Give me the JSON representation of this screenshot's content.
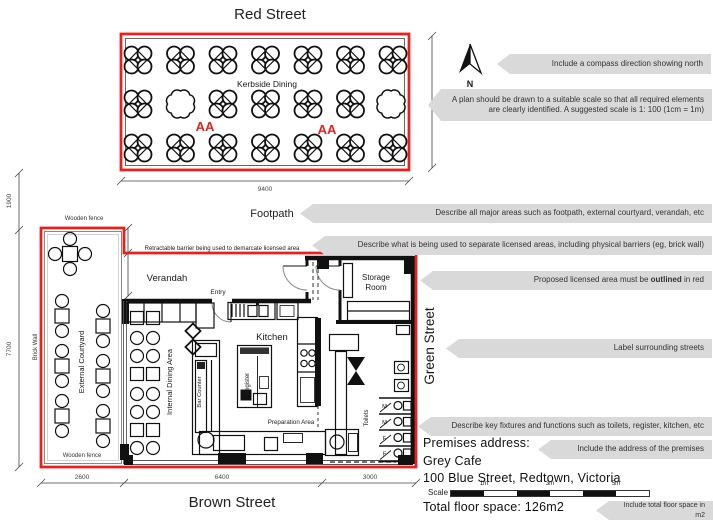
{
  "streets": {
    "top": "Red Street",
    "bottom": "Brown Street",
    "right": "Green Street",
    "footpath": "Footpath"
  },
  "kerbside": {
    "label": "Kerbside Dining",
    "area_marker_1": "AA",
    "area_marker_2": "AA"
  },
  "compass": {
    "north": "N"
  },
  "plan": {
    "verandah": "Verandah",
    "entry": "Entry",
    "kitchen": "Kitchen",
    "register": "Register",
    "storage_line1": "Storage",
    "storage_line2": "Room",
    "bar_counter": "Bar Counter",
    "internal_dining": "Internal Dining Area",
    "external_courtyard": "External Courtyard",
    "preparation_area": "Preparation Area",
    "toilets": "Toilets",
    "toilet_stalls": [
      "M",
      "M",
      "F",
      "F"
    ],
    "brick_wall": "Brick Wall",
    "wooden_fence_top": "Wooden fence",
    "wooden_fence_bottom": "Wooden fence",
    "retractable_barrier": "Retractable barrier being used to demarcate licensed area"
  },
  "dimensions": {
    "kerbside_width": "9400",
    "kerbside_depth": "4400",
    "footpath_width": "1900",
    "courtyard_depth": "7700",
    "courtyard_width": "2600",
    "building_width": "6400",
    "east_width": "3000",
    "barrier_step": "800",
    "verandah_edge": "1400"
  },
  "callouts": {
    "compass": "Include a compass direction showing north",
    "scale_note": "A plan should be drawn to a suitable scale so that all required elements are clearly identified. A suggested scale is 1: 100 (1cm = 1m)",
    "major_areas": "Describe all major areas such as footpath, external courtyard, verandah, etc",
    "separation": "Describe what is being used to separate licensed areas, including physical barriers (eg, brick wall)",
    "outline_prefix": "Proposed licensed area must be ",
    "outline_bold": "outlined",
    "outline_suffix": " in red",
    "streets_note": "Label surrounding streets",
    "fixtures": "Describe key fixtures and functions such as toilets, register, kitchen, etc",
    "address_note": "Include the address of the premises",
    "floorspace_note": "Include total floor space in m2"
  },
  "premises": {
    "label": "Premises address:",
    "name": "Grey Cafe",
    "street_address": "100 Blue Street, Redtown, Victoria",
    "floor_space": "Total floor space: 126m2"
  },
  "scale_bar": {
    "label": "Scale",
    "ticks": [
      "1m",
      "3m",
      "5m"
    ]
  },
  "colors": {
    "licensed-red": "#e8211c",
    "callout-bg": "#d9d9d9",
    "ink": "#1a1a1a"
  }
}
